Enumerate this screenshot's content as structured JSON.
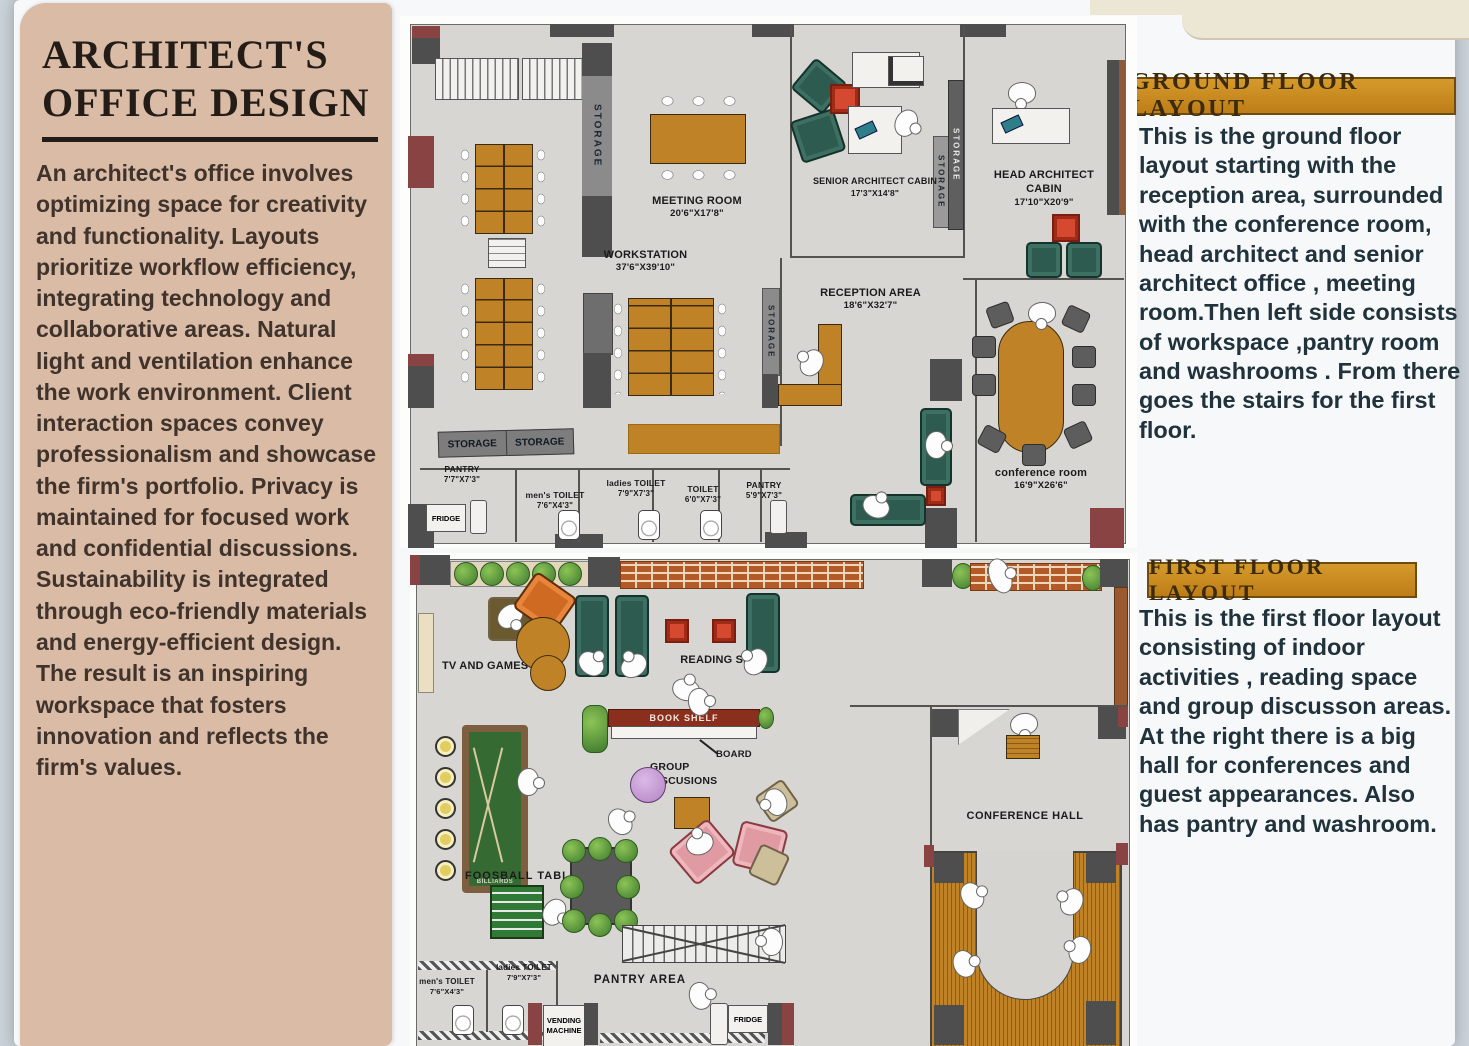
{
  "left_panel": {
    "title_line1": "ARCHITECT'S",
    "title_line2": "OFFICE DESIGN",
    "paragraphs": [
      "An architect's office involves optimizing space for creativity and functionality. Layouts prioritize workflow efficiency, integrating technology and collaborative areas. Natural light and ventilation enhance the work environment. Client interaction spaces convey professionalism and showcase the firm's portfolio. Privacy is maintained for focused work and confidential discussions.",
      "Sustainability is integrated through eco-friendly materials and energy-efficient design.",
      "The result is an inspiring workspace that fosters innovation and reflects the firm's values."
    ]
  },
  "right_panel": {
    "ground": {
      "header": "GROUND FLOOR LAYOUT",
      "body": "This is the ground floor layout starting with the reception area, surrounded with the conference room, head architect and senior architect office , meeting room.Then left side consists of workspace ,pantry room and washrooms . From there goes the stairs for the first floor."
    },
    "first": {
      "header": "FIRST FLOOR LAYOUT",
      "body": "This is the first floor layout consisting of indoor activities , reading space and group discusson areas. At the right there is a big hall for conferences and guest appearances. Also has pantry and washroom."
    }
  },
  "ground_floor": {
    "meeting_room": {
      "name": "MEETING ROOM",
      "dim": "20'6\"X17'8\""
    },
    "workstation": {
      "name": "WORKSTATION",
      "dim": "37'6\"X39'10\""
    },
    "reception": {
      "name": "RECEPTION AREA",
      "dim": "18'6\"X32'7\""
    },
    "senior_cabin": {
      "name": "SENIOR ARCHITECT CABIN",
      "dim": "17'3\"X14'8\""
    },
    "head_cabin": {
      "name": "HEAD ARCHITECT CABIN",
      "dim": "17'10\"X20'9\""
    },
    "conference_room": {
      "name": "conference room",
      "dim": "16'9\"X26'6\""
    },
    "pantry_left": {
      "name": "PANTRY",
      "dim": "7'7\"X7'3\""
    },
    "mens_toilet": {
      "name": "men's TOILET",
      "dim": "7'6\"X4'3\""
    },
    "ladies_toilet": {
      "name": "ladies TOILET",
      "dim": "7'9\"X7'3\""
    },
    "toilet": {
      "name": "TOILET",
      "dim": "6'0\"X7'3\""
    },
    "pantry_right": {
      "name": "PANTRY",
      "dim": "5'9\"X7'3\""
    },
    "storage": "STORAGE",
    "fridge": "FRIDGE"
  },
  "first_floor": {
    "tv_and_games": "TV AND GAMES",
    "reading_space": "READING SPACE",
    "book_shelf": "BOOK SHELF",
    "board": "BOARD",
    "group_discussions_line1": "GROUP",
    "group_discussions_line2": "DISCUSIONS",
    "billiards": "BILLIARDS",
    "foosball_table": "FOOSBALL TABLE",
    "pantry_area": "PANTRY AREA",
    "conference_hall": "CONFERENCE HALL",
    "vending_machine": "VENDING MACHINE",
    "fridge": "FRIDGE",
    "mens_toilet": {
      "name": "men's TOILET",
      "dim": "7'6\"X4'3\""
    },
    "ladies_toilet": {
      "name": "ladies TOILET",
      "dim": "7'9\"X7'3\""
    }
  },
  "colors": {
    "poster_bg": "#f7f8f9",
    "left_panel_bg": "#d9bba6",
    "header_bar": "#c8861f",
    "floor": "#d8d6d2",
    "wall_dark": "#4e4e4e",
    "wall_maroon": "#8a4343",
    "furniture_orange": "#c08226",
    "sofa_green": "#2d5b50",
    "accent_red": "#d4492f",
    "sofa_pink": "#e09aa2",
    "brick": "#b35a26"
  },
  "icons": {
    "person": "white rounded blob with head circle",
    "toilet": "rounded rect with bowl circle",
    "plant": "green radial circle",
    "stairs": "treaded rect with X cross",
    "storage_strip": "gray strip with vertical text"
  }
}
